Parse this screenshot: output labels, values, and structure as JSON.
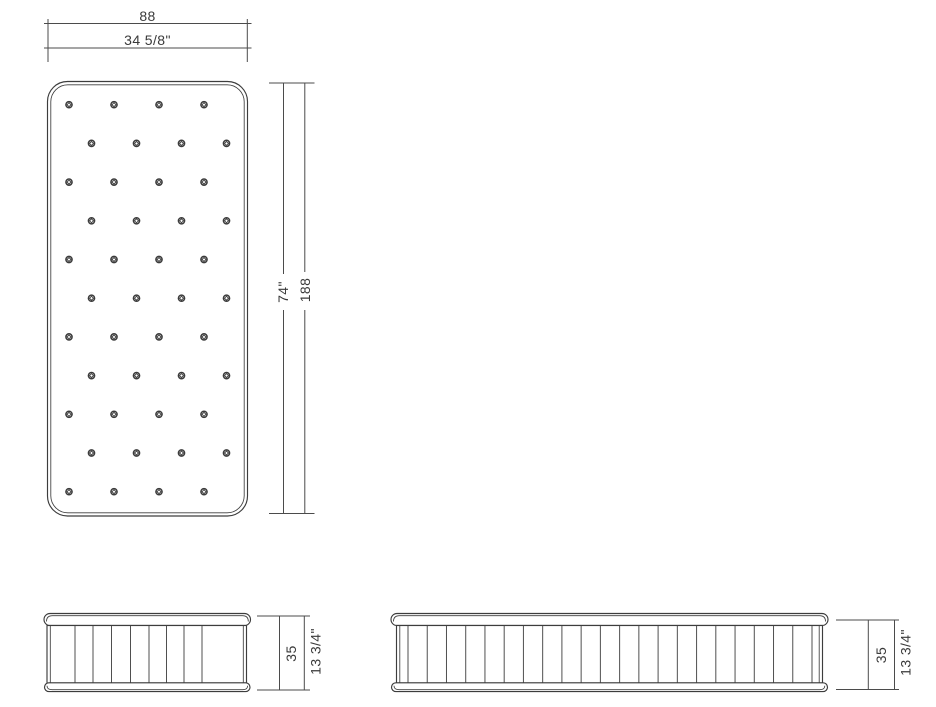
{
  "drawing_title": "mattress technical drawing",
  "dims": {
    "width_cm": "88",
    "width_in": "34 5/8\"",
    "length_in": "74\"",
    "length_cm": "188",
    "height_front_cm": "35",
    "height_front_in": "13 3/4\"",
    "height_side_cm": "35",
    "height_side_in": "13 3/4\""
  },
  "top_view": {
    "tuft_rows": 11,
    "tufts_per_row": 4,
    "tuft_total": 44
  },
  "front_view": {
    "pleat_count": 8
  },
  "side_view": {
    "pleat_count": 22
  }
}
